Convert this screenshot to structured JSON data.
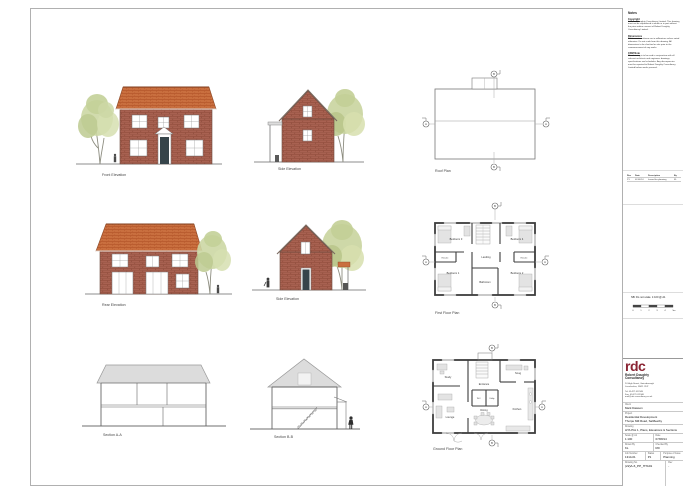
{
  "sheet": {
    "labels": {
      "front_elevation": "Front Elevation",
      "side_elevation_1": "Side Elevation",
      "roof_plan": "Roof Plan",
      "rear_elevation": "Rear Elevation",
      "side_elevation_2": "Side Elevation",
      "first_floor_plan": "First Floor Plan",
      "section_aa": "Section A-A",
      "section_bb": "Section B-B",
      "ground_floor_plan": "Ground Floor Plan"
    },
    "markers": {
      "a": "A",
      "b": "B"
    },
    "first_floor_rooms": {
      "bedroom1": "Bedroom 1",
      "bedroom2": "Bedroom 2",
      "bedroom3": "Bedroom 3",
      "bedroom4": "Bedroom 4",
      "landing": "Landing",
      "bathroom": "Bathroom",
      "ensuite1": "Ensuite",
      "ensuite2": "Ensuite"
    },
    "ground_floor_rooms": {
      "study": "Study",
      "entrance": "Entrance",
      "snug": "Snug",
      "lounge": "Lounge",
      "dining": "Dining",
      "kitchen": "Kitchen",
      "wc": "W.C.",
      "utility": "Utility"
    },
    "notes": {
      "title": "Notes",
      "sections": [
        {
          "heading": "Copyright",
          "body": "© Robert Doughty Consultancy Limited. This drawing must not be reproduced in whole or in part without the prior written consent of Robert Doughty Consultancy Limited."
        },
        {
          "heading": "Dimensions",
          "body": "All dimensions shown are in millimetres unless noted otherwise. Do not scale from this drawing. All dimensions to be checked on site prior to the commencement of any works."
        },
        {
          "heading": "CDM Note",
          "body": "This drawing is to be read in conjunction with all relevant architects and engineers drawings, specifications and schedules. Any discrepancies must be reported to Robert Doughty Consultancy Limited before works proceed."
        }
      ]
    },
    "revisions": {
      "headers": [
        "Rev",
        "Date",
        "Description",
        "By"
      ],
      "rows": [
        [
          "P1",
          "02.08.14",
          "Issued for planning",
          "KL"
        ]
      ]
    },
    "scale_note": "NB: Do not scale. 1:100 @ A1",
    "scale_bar_ticks": [
      "0",
      "1",
      "2",
      "3",
      "4",
      "5m"
    ],
    "title_block": {
      "logo": "rdc",
      "company_line1": "Robert Doughty",
      "company_line2": "Consultancy",
      "address_lines": [
        "24 High Street, Gainsborough",
        "Lincolnshire, DN21 2DP"
      ],
      "contact_lines": [
        "Tel: 01427 612345",
        "Fax: 01427 612346",
        "mail@rdc-consultancy.co.uk"
      ],
      "client_label": "Client",
      "client_value": "Mark Dawson",
      "project_label": "Project",
      "project_line1": "Residential Development",
      "project_line2": "Thorpe Mill Road, Saltfleetby",
      "drawing_label": "Drawing",
      "drawing_title": "HTA Plot 1, Plans, Elevations & Sections",
      "scale_label": "Scale @ A1",
      "scale_value": "1:100",
      "date_label": "Date",
      "date_value": "07/08/14",
      "drawn_label": "Drawn By",
      "drawn_value": "KL",
      "checked_label": "Checked By",
      "checked_value": "RD",
      "job_label": "Job Number",
      "job_value": "1314-01",
      "status_label": "Status",
      "status_value": "P1",
      "purpose_label": "Purpose of Issue",
      "purpose_value": "Planning",
      "drawing_no_label": "Drawing No.",
      "drawing_no_value": "(22)A-6_PP_HTA01",
      "rev_label": "Rev",
      "rev_value": "-"
    }
  }
}
